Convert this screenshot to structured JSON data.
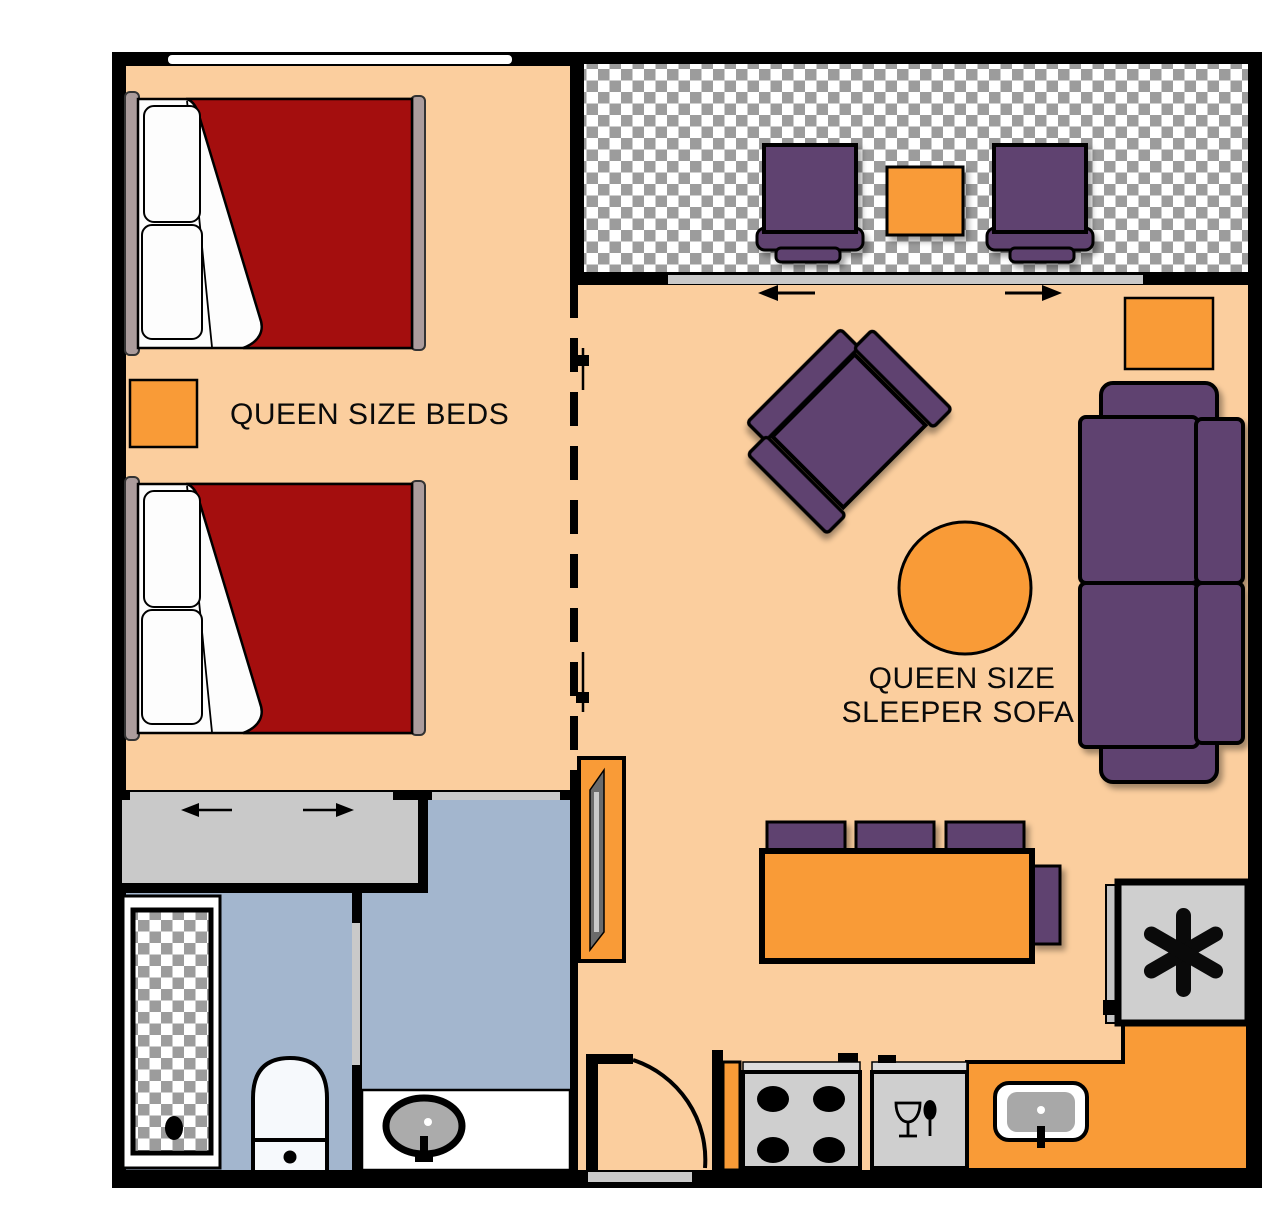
{
  "plan": {
    "type": "apartment-suite-floor-plan",
    "labels": {
      "beds": "QUEEN SIZE BEDS",
      "sofa_line1": "QUEEN SIZE",
      "sofa_line2": "SLEEPER SOFA"
    },
    "rooms": {
      "bedroom": [
        "queen-bed",
        "queen-bed",
        "window"
      ],
      "balcony": [
        "patio-chair",
        "patio-table",
        "patio-chair",
        "sliding-door"
      ],
      "living_room": [
        "armchair",
        "round-table",
        "sleeper-sofa",
        "side-table",
        "tv-console",
        "dining-table",
        "dining-chairs"
      ],
      "closet": [
        "sliding-doors"
      ],
      "bathroom_1": [
        "bathtub",
        "toilet"
      ],
      "bathroom_2": [
        "vanity-sink"
      ],
      "kitchen": [
        "stove",
        "dishwasher",
        "kitchen-sink",
        "refrigerator",
        "entry-door"
      ]
    },
    "icons": {
      "closet_doors": "slide-left-right-arrows",
      "balcony_doors": "slide-left-right-arrows",
      "refrigerator": "asterisk-icon",
      "dishwasher": "wine-glass-and-spoon-icon",
      "entry": "door-swing-arc-icon"
    },
    "colors": {
      "wall": "#000000",
      "floor_peach": "#FBCE9E",
      "accent_orange": "#F99B37",
      "furniture_purple": "#5E4270",
      "bed_red": "#A40E0E",
      "bathroom_blue": "#A3B6CE",
      "appliance_gray": "#CFCFCF",
      "door_gray": "#C9C9C9",
      "headboard_tan": "#AB9C9C",
      "checker_gray": "#9C9C9C"
    }
  }
}
